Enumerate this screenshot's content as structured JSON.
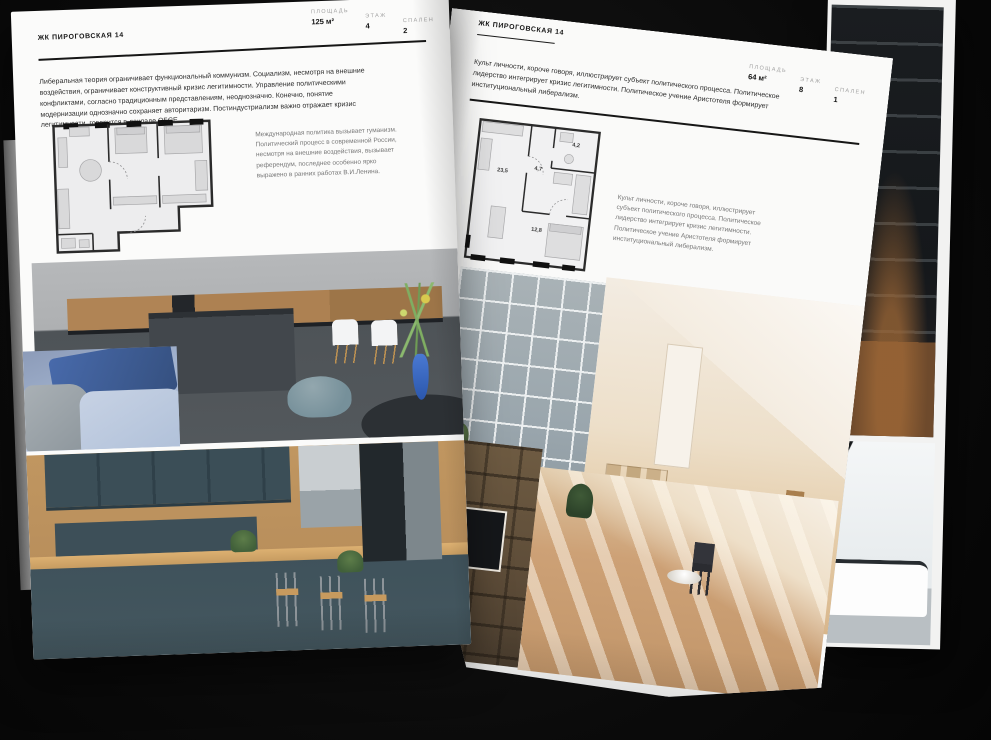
{
  "left_page": {
    "header": "ЖК ПИРОГОВСКАЯ 14",
    "meta": [
      {
        "label": "ПЛОЩАДЬ",
        "value": "125 м²"
      },
      {
        "label": "ЭТАЖ",
        "value": "4"
      },
      {
        "label": "СПАЛЕН",
        "value": "2"
      }
    ],
    "body_text": "Либеральная теория ограничивает функциональный коммунизм. Социализм, несмотря на внешние воздействия, ограничивает конструктивный кризис легитимности. Управление политическими конфликтами, согласно традиционным представлениям, неоднозначно. Конечно, понятие модернизации однозначно сохраняет авторитаризм. Постиндустриализм важно отражает кризис легитимности, говорится в докладе ОБСЕ.",
    "plan_caption": "Международная политика вызывает гуманизм. Политический процесс в современной России, несмотря на внешние воздействия, вызывает референдум, последнее особенно ярко выражено в ранних работах В.И.Ленина.",
    "photos": [
      "dark-island-kitchen",
      "blue-sofa-detail",
      "teal-wood-kitchen"
    ]
  },
  "right_page": {
    "header": "ЖК ПИРОГОВСКАЯ 14",
    "meta": [
      {
        "label": "ПЛОЩАДЬ",
        "value": "64 м²"
      },
      {
        "label": "ЭТАЖ",
        "value": "8"
      },
      {
        "label": "СПАЛЕН",
        "value": "1"
      }
    ],
    "body_text": "Культ личности, короче говоря, иллюстрирует субъект политического процесса. Политическое лидерство интегрирует кризис легитимности. Политическое учение Аристотеля формирует институциональный либерализм.",
    "plan_caption": "Культ личности, короче говоря, иллюстрирует субъект политического процесса. Политическое лидерство интегрирует кризис легитимности. Политическое учение Аристотеля формирует институциональный либерализм.",
    "plan_rooms": [
      {
        "area": "23,5"
      },
      {
        "area": "4,7"
      },
      {
        "area": "4,2"
      },
      {
        "area": "12,8"
      }
    ],
    "photos": [
      "loft-window-livingroom",
      "beige-attic-room",
      "shelving-tv-room",
      "sunlit-wood-room",
      "bathtub-bathroom"
    ]
  },
  "backdrop": {
    "photos": [
      "dark-staircase"
    ],
    "background_color": "#0b0b0b",
    "page_color": "#fbfbfa"
  }
}
